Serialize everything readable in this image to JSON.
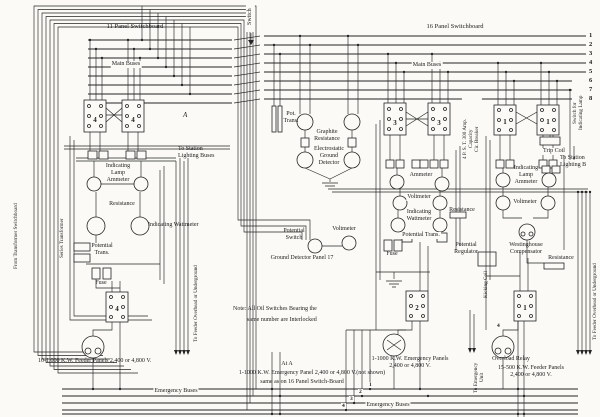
{
  "colors": {
    "ink": "#242424",
    "paper": "#fbfaf6"
  },
  "boards": {
    "left_title": "11 Panel Switchboard",
    "right_title": "16 Panel Switchboard",
    "main_buses_left": "Main Buses",
    "main_buses_right": "Main Buses"
  },
  "bus_numbers": [
    "1",
    "2",
    "3",
    "4",
    "5",
    "6",
    "7",
    "8"
  ],
  "em_bus_numbers": [
    "1",
    "2",
    "3",
    "4"
  ],
  "switches": {
    "left_pair": "4",
    "mid_pair": "3",
    "right_pair": "1",
    "left_feeder": "4",
    "emergency": "2",
    "right_feeder": "1"
  },
  "labels": {
    "switch_vertical": "Switch",
    "pot_trans_abbrev": "Pot.\nTrans.",
    "graphite_resistance": "Graphite\nResistance",
    "electrostatic_ground_detector": "Electrostatic\nGround\nDetector",
    "station_lighting_left": "To Station\nLighting Buses",
    "lamp_ammeter_left": "Indicating\nLamp\nAmmeter",
    "resistance_left": "Resistance",
    "wattmeter_left": "Indicating Wattmeter",
    "potential_trans_left": "Potential\nTrans.",
    "fuse_left": "Fuse",
    "series_transformer": "Series Transformer",
    "from_transfer": "From Transformer Switchboard",
    "marker_a": "A",
    "to_feeder_left": "To Feeder Overhead or Underground",
    "feeder_panels_left": "10-1,000 K.W. Feeder Panels 2,400 or 4,800 V.",
    "emergency_buses_left": "Emergency Buses",
    "potential_switch": "Potential\nSwitch",
    "voltmeter_gd": "Voltmeter",
    "gd_panel_title": "Ground Detector Panel 17",
    "ammeter_mid": "Ammeter",
    "voltmeter_mid": "Voltmeter",
    "wattmeter_mid": "Indicating\nWattmeter",
    "resistance_mid": "Resistance",
    "potential_trans_mid": "Potential Trans.",
    "fuse_mid": "Fuse",
    "potential_regulator": "Potential\nRegulator",
    "breaker_vertical": "4 P. S. T. 300 Amp.\nCapacity\nCir. Breaker",
    "kicking_coil": "Kicking Coil",
    "emergency_panels_mid": "1-1000 K.W. Emergency Panels\n2,400 or 4,800 V.",
    "to_emergency_unit": "To Emergency\nUnit",
    "switch_for_lamp": "Switch for\nIndicating Lamp",
    "trip_coil": "Trip Coil",
    "station_lighting_right": "To Station\nLighting B",
    "lamp_ammeter_right": "Indicating\nLamp\nAmmeter",
    "voltmeter_right": "Voltmeter",
    "westinghouse": "Westinghouse\nCompensator",
    "resistance_right": "Resistance",
    "relay_panel_number": "4",
    "overload_relay": "Overload Relay",
    "feeder_panels_right": "15-500 K.W. Feeder Panels\n2,400 or 4,800 V.",
    "to_feeder_right": "To Feeder Overhead or Underground",
    "note_line1": "Note:   All Oil Switches Bearing the",
    "note_line2": "same number are Interlocked",
    "at_a": "At A",
    "emergency_panel_note_1": "1-1000 K.W. Emergency Panel 2,400 or 4,800 V.(not shown)",
    "emergency_panel_note_2": "same as on 16 Panel Switch-Board",
    "emergency_buses_right": "Emergency Buses"
  }
}
